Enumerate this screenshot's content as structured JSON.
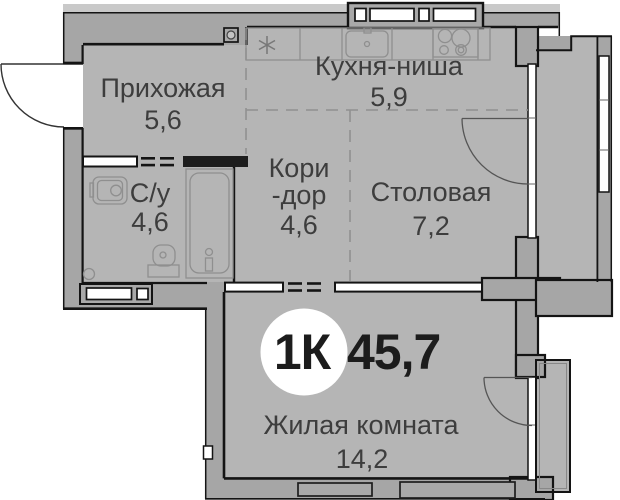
{
  "plan": {
    "badge": {
      "type": "1К",
      "total_area": "45,7"
    },
    "rooms": [
      {
        "name": "Прихожая",
        "area": "5,6"
      },
      {
        "name": "Кухня-ниша",
        "area": "5,9"
      },
      {
        "name": "С/у",
        "area": "4,6"
      },
      {
        "name_line1": "Кори",
        "name_line2": "-дор",
        "area": "4,6"
      },
      {
        "name": "Столовая",
        "area": "7,2"
      },
      {
        "name": "Жилая комната",
        "area": "14,2"
      }
    ],
    "colors": {
      "floor": "#b5b5b5",
      "wall": "#a6a6a6",
      "outline": "#141414",
      "exterior_band": "#c9c9c9",
      "label_text": "#3d3d3d",
      "badge_text": "#1c1c1c",
      "badge_bg": "#ffffff"
    },
    "icons": [
      "entrance-door-icon",
      "peephole-icon",
      "fridge-asterisk-icon",
      "kitchen-sink-icon",
      "stove-icon",
      "washbasin-icon",
      "bathtub-icon",
      "toilet-icon",
      "vent-shaft-icon",
      "balcony-door-icon",
      "window-icon"
    ]
  }
}
